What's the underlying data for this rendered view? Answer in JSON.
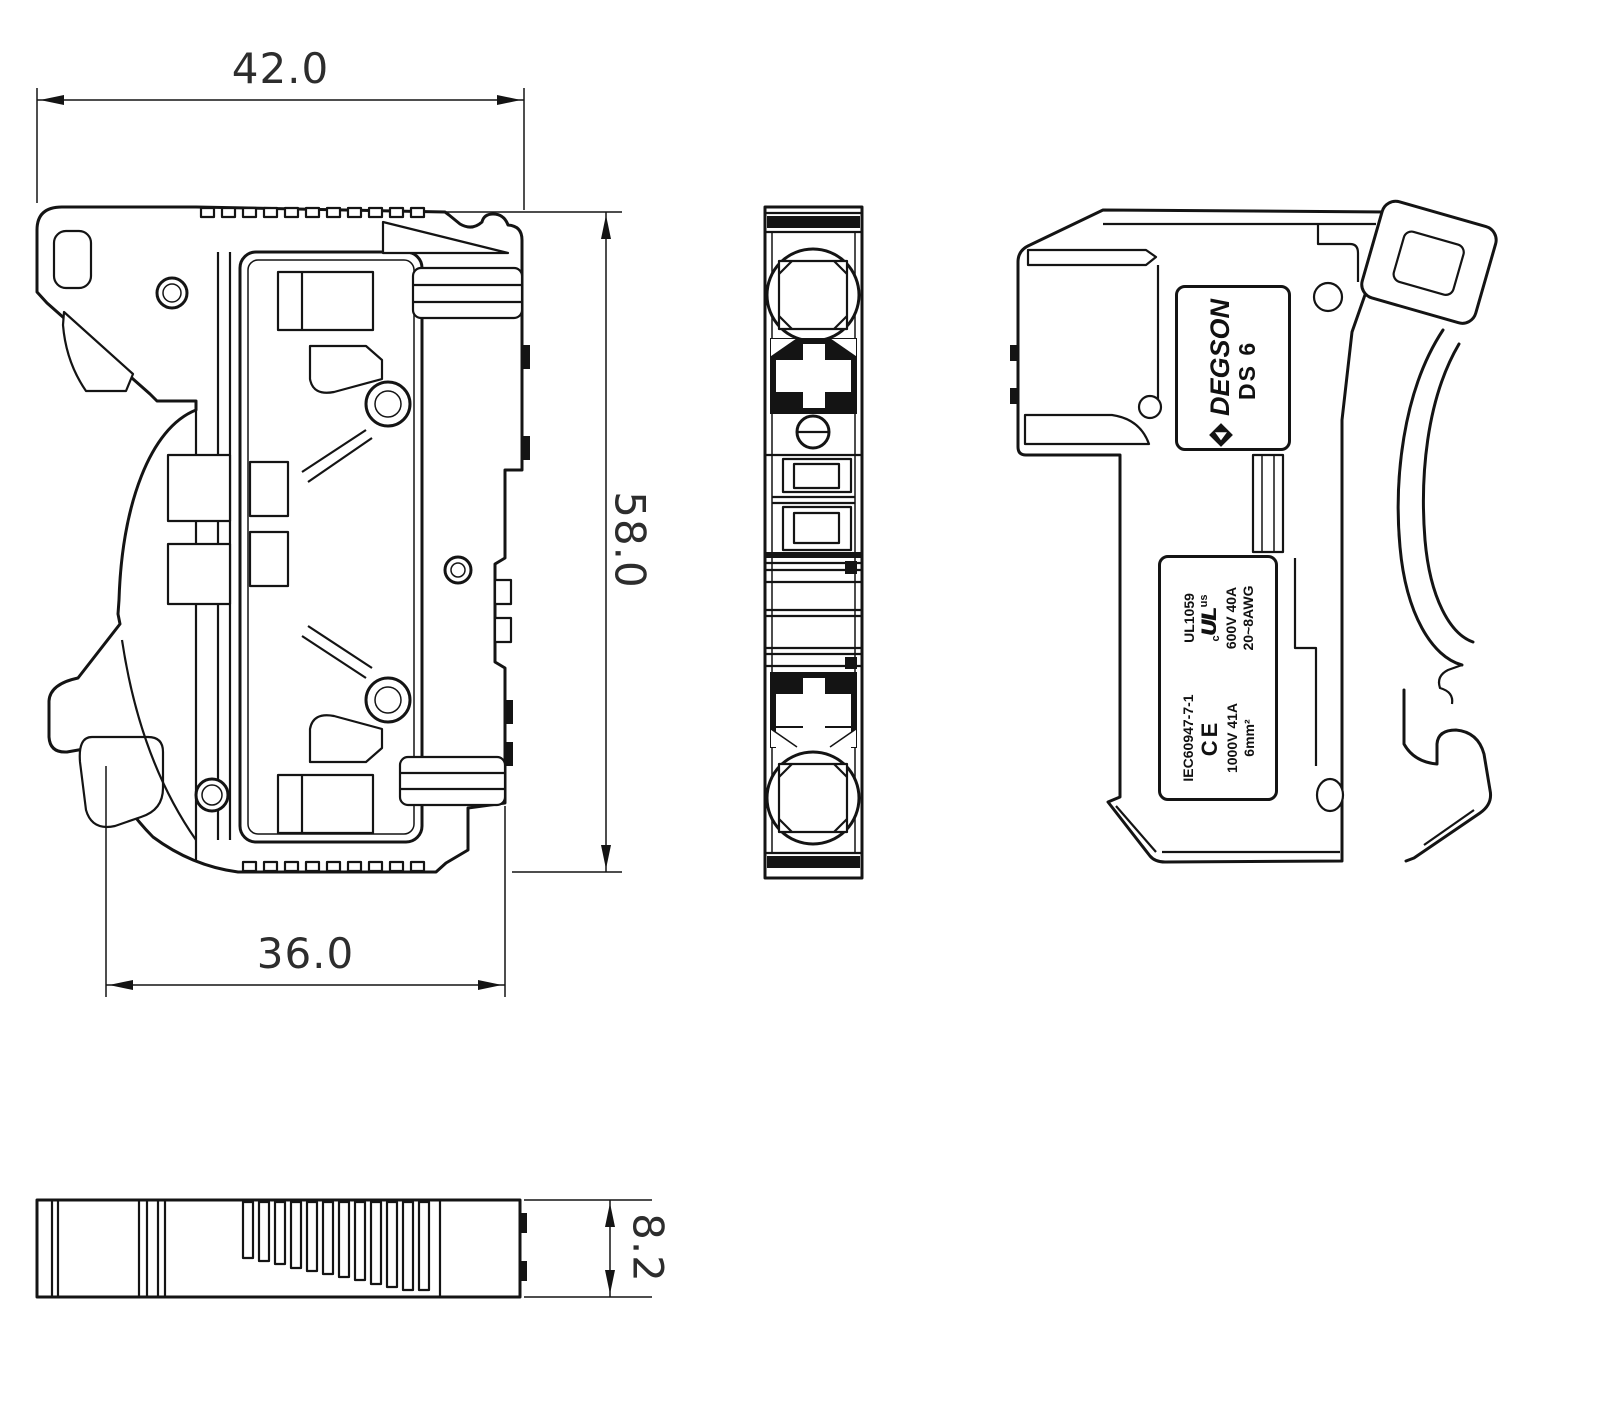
{
  "drawing": {
    "dimensions": {
      "top_width": "42.0",
      "overall_height": "58.0",
      "bottom_width": "36.0",
      "rail_depth": "8.2"
    },
    "brand_label": {
      "brand": "DEGSON",
      "model": "DS 6"
    },
    "cert_label": {
      "iec_standard": "IEC60947-7-1",
      "ce_mark": "CE",
      "iec_rating": "1000V 41A",
      "iec_wire": "6mm²",
      "ul_standard": "UL1059",
      "ul_prefix": "c",
      "ul_mark": "UL",
      "ul_suffix": "us",
      "ul_rating": "600V 40A",
      "ul_wire": "20~8AWG"
    }
  }
}
